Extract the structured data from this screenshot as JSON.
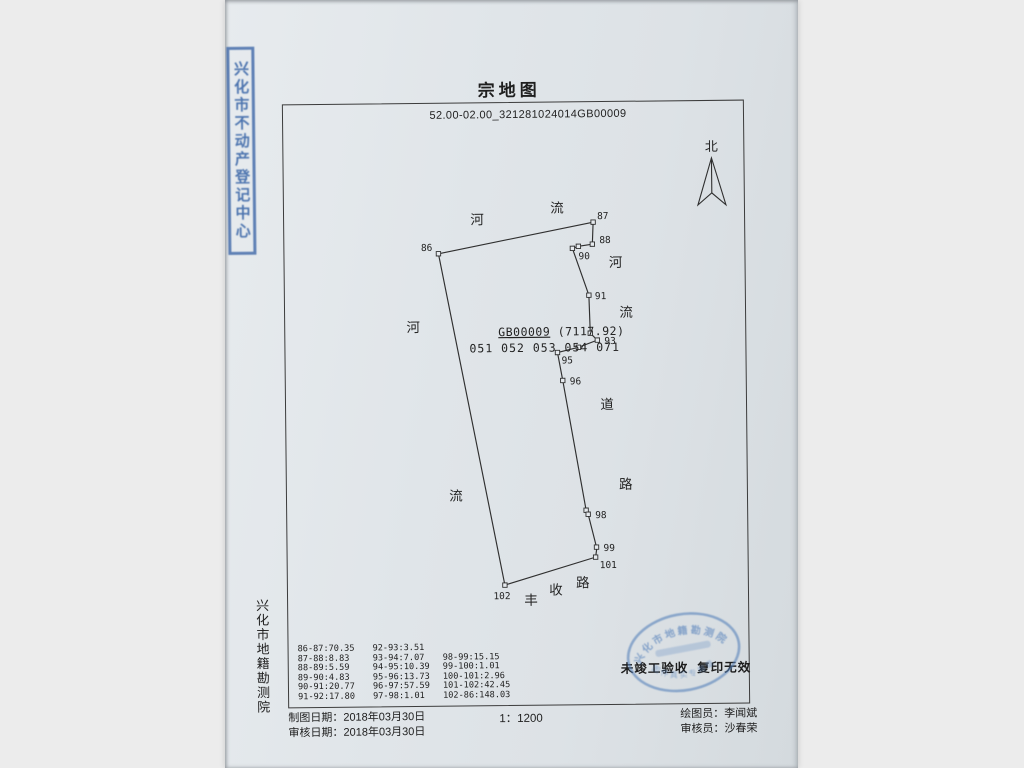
{
  "colors": {
    "background": "#ececec",
    "paper": "#dfe4e8",
    "ink": "#2e2e2e",
    "stamp_blue": "#3d67a8"
  },
  "title": "宗地图",
  "subtitle": "52.00-02.00_321281024014GB00009",
  "north_label": "北",
  "map": {
    "parcel_label": "GB00009",
    "parcel_area": "(7117.92)",
    "parcel_subcodes": "051 052 053 054 071",
    "order": [
      "86",
      "87",
      "88",
      "89",
      "90",
      "91",
      "92",
      "93",
      "94",
      "95",
      "96",
      "97",
      "98",
      "99",
      "100",
      "101",
      "102"
    ],
    "points": [
      {
        "id": "86",
        "x": 154,
        "y": 150,
        "lx": 148,
        "ly": 147,
        "anchor": "end"
      },
      {
        "id": "87",
        "x": 309,
        "y": 120,
        "lx": 313,
        "ly": 117,
        "anchor": "start"
      },
      {
        "id": "88",
        "x": 308,
        "y": 142,
        "lx": 315,
        "ly": 141,
        "anchor": "start"
      },
      {
        "id": "89",
        "x": 294,
        "y": 144
      },
      {
        "id": "90",
        "x": 288,
        "y": 146,
        "lx": 294,
        "ly": 157,
        "anchor": "start"
      },
      {
        "id": "91",
        "x": 304,
        "y": 193,
        "lx": 310,
        "ly": 197,
        "anchor": "start"
      },
      {
        "id": "92",
        "x": 305,
        "y": 231
      },
      {
        "id": "93",
        "x": 312,
        "y": 238,
        "lx": 319,
        "ly": 242,
        "anchor": "start"
      },
      {
        "id": "94",
        "x": 293,
        "y": 245
      },
      {
        "id": "95",
        "x": 272,
        "y": 250,
        "lx": 276,
        "ly": 261,
        "anchor": "start"
      },
      {
        "id": "96",
        "x": 277,
        "y": 278,
        "lx": 284,
        "ly": 282,
        "anchor": "start"
      },
      {
        "id": "97",
        "x": 299,
        "y": 408
      },
      {
        "id": "98",
        "x": 301,
        "y": 412,
        "lx": 308,
        "ly": 416,
        "anchor": "start"
      },
      {
        "id": "99",
        "x": 309,
        "y": 445,
        "lx": 316,
        "ly": 449,
        "anchor": "start"
      },
      {
        "id": "100",
        "x": 309,
        "y": 448,
        "nomark": true
      },
      {
        "id": "101",
        "x": 308,
        "y": 455,
        "lx": 312,
        "ly": 466,
        "anchor": "start"
      },
      {
        "id": "102",
        "x": 217,
        "y": 482,
        "lx": 214,
        "ly": 496,
        "anchor": "middle"
      }
    ],
    "area_labels": [
      {
        "t": "河",
        "x": 193,
        "y": 121
      },
      {
        "t": "流",
        "x": 273,
        "y": 110
      },
      {
        "t": "河",
        "x": 331,
        "y": 165
      },
      {
        "t": "流",
        "x": 341,
        "y": 215
      },
      {
        "t": "河",
        "x": 128,
        "y": 228
      },
      {
        "t": "道",
        "x": 321,
        "y": 307
      },
      {
        "t": "路",
        "x": 339,
        "y": 387
      },
      {
        "t": "流",
        "x": 169,
        "y": 397
      },
      {
        "t": "丰",
        "x": 243,
        "y": 502
      },
      {
        "t": "收",
        "x": 268,
        "y": 492
      },
      {
        "t": "路",
        "x": 295,
        "y": 485
      }
    ],
    "gb_line1_pos": {
      "x": 213,
      "y": 233
    },
    "gb_line2_pos": {
      "x": 184,
      "y": 249
    }
  },
  "distance_table": {
    "col1": [
      "86-87:70.35",
      "87-88:8.83",
      "88-89:5.59",
      "89-90:4.83",
      "90-91:20.77",
      "91-92:17.80"
    ],
    "col2": [
      "92-93:3.51",
      "93-94:7.07",
      "94-95:10.39",
      "95-96:13.73",
      "96-97:57.59",
      "97-98:1.01"
    ],
    "col3": [
      "98-99:15.15",
      "99-100:1.01",
      "100-101:2.96",
      "101-102:42.45",
      "102-86:148.03"
    ]
  },
  "notice": "未竣工验收  复印无效",
  "org_vertical": "兴化市地籍勘测院",
  "stamps": {
    "side_text": "兴化市不动产登记中心",
    "oval_arc_top": "兴化市地籍勘测院",
    "oval_arc_bottom": "图件真实专用章"
  },
  "footer": {
    "made_label": "制图日期：",
    "made_date": "2018年03月30日",
    "review_label": "审核日期：",
    "review_date": "2018年03月30日",
    "scale": "1：1200",
    "drafter_label": "绘图员：",
    "drafter": "李闻斌",
    "checker_label": "审核员：",
    "checker": "沙春荣"
  }
}
